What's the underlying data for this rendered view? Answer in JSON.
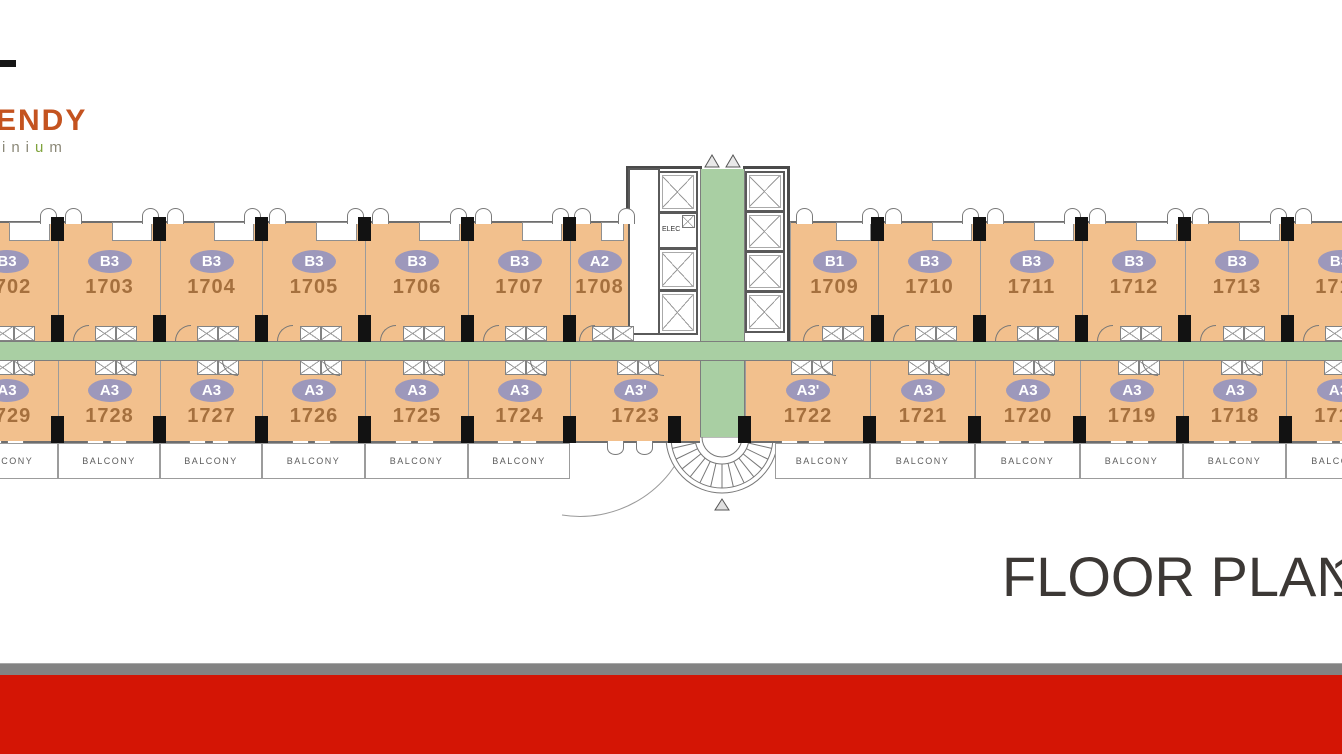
{
  "logo": {
    "top": "ENDY",
    "bottom_pre": "ini",
    "bottom_mid": "u",
    "bottom_post": "m"
  },
  "title": {
    "text": "FLOOR PLAN",
    "suffix": "1"
  },
  "labels": {
    "balcony": "BALCONY",
    "elec": "ELEC"
  },
  "colors": {
    "unit": "#f2c08d",
    "badge": "#9d98bb",
    "badge_text": "#ffffff",
    "unit_number": "#a5703e",
    "corridor": "#a9cfa3",
    "wall": "#6e6e6e",
    "column": "#121212",
    "red_bar": "#d41505",
    "gray_bar": "#838383",
    "title": "#3c3835",
    "logo_orange": "#c4531f",
    "logo_gray": "#8b8877",
    "logo_green": "#7fa33c"
  },
  "floorplan": {
    "top_units": [
      {
        "type": "B3",
        "num": "1702",
        "x": -45,
        "w": 103
      },
      {
        "type": "B3",
        "num": "1703",
        "x": 58,
        "w": 102
      },
      {
        "type": "B3",
        "num": "1704",
        "x": 160,
        "w": 102
      },
      {
        "type": "B3",
        "num": "1705",
        "x": 262,
        "w": 103
      },
      {
        "type": "B3",
        "num": "1706",
        "x": 365,
        "w": 103
      },
      {
        "type": "B3",
        "num": "1707",
        "x": 468,
        "w": 102
      },
      {
        "type": "A2",
        "num": "1708",
        "x": 570,
        "w": 58
      },
      {
        "type": "B1",
        "num": "1709",
        "x": 790,
        "w": 88
      },
      {
        "type": "B3",
        "num": "1710",
        "x": 878,
        "w": 102
      },
      {
        "type": "B3",
        "num": "1711",
        "x": 980,
        "w": 102
      },
      {
        "type": "B3",
        "num": "1712",
        "x": 1082,
        "w": 103
      },
      {
        "type": "B3",
        "num": "1713",
        "x": 1185,
        "w": 103
      },
      {
        "type": "B3",
        "num": "1714",
        "x": 1288,
        "w": 102
      }
    ],
    "bottom_units": [
      {
        "type": "A3",
        "num": "1729",
        "x": -45,
        "w": 103
      },
      {
        "type": "A3",
        "num": "1728",
        "x": 58,
        "w": 102
      },
      {
        "type": "A3",
        "num": "1727",
        "x": 160,
        "w": 102
      },
      {
        "type": "A3",
        "num": "1726",
        "x": 262,
        "w": 103
      },
      {
        "type": "A3",
        "num": "1725",
        "x": 365,
        "w": 103
      },
      {
        "type": "A3",
        "num": "1724",
        "x": 468,
        "w": 102
      },
      {
        "type": "A3'",
        "num": "1723",
        "x": 570,
        "w": 130
      },
      {
        "type": "A3'",
        "num": "1722",
        "x": 745,
        "w": 125
      },
      {
        "type": "A3",
        "num": "1721",
        "x": 870,
        "w": 105
      },
      {
        "type": "A3",
        "num": "1720",
        "x": 975,
        "w": 105
      },
      {
        "type": "A3",
        "num": "1719",
        "x": 1080,
        "w": 103
      },
      {
        "type": "A3",
        "num": "1718",
        "x": 1183,
        "w": 103
      },
      {
        "type": "A3",
        "num": "1717",
        "x": 1286,
        "w": 104
      }
    ],
    "balconies": [
      {
        "x": -45,
        "w": 103
      },
      {
        "x": 58,
        "w": 102
      },
      {
        "x": 160,
        "w": 102
      },
      {
        "x": 262,
        "w": 103
      },
      {
        "x": 365,
        "w": 103
      },
      {
        "x": 468,
        "w": 102
      },
      {
        "x": 775,
        "w": 95
      },
      {
        "x": 870,
        "w": 105
      },
      {
        "x": 975,
        "w": 105
      },
      {
        "x": 1080,
        "w": 103
      },
      {
        "x": 1183,
        "w": 103
      },
      {
        "x": 1286,
        "w": 104
      }
    ],
    "columns": {
      "top_upper_y": 217,
      "top_upper_h": 24,
      "top_lower_y": 315,
      "top_lower_h": 27,
      "bottom_y": 416,
      "bottom_h": 27,
      "top_x": [
        51,
        153,
        255,
        358,
        461,
        563,
        871,
        973,
        1075,
        1178,
        1281
      ],
      "bottom_x": [
        51,
        153,
        255,
        358,
        461,
        563,
        668,
        738,
        863,
        968,
        1073,
        1176,
        1279
      ]
    }
  }
}
